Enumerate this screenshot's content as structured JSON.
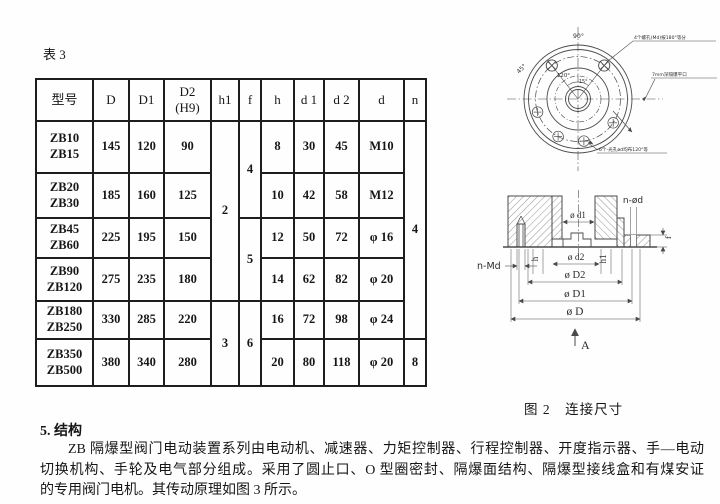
{
  "doc": {
    "table_caption": "表 3",
    "figure_caption": "图 2　连接尺寸",
    "section_heading": "5. 结构",
    "para_line1": "ZB 隔爆型阀门电动装置系列由电动机、减速器、力矩控制器、行程控制器、开度指示器、手—电动",
    "para_line2": "切换机构、手轮及电气部分组成。采用了圆止口、O 型圈密封、隔爆面结构、隔爆型接线盒和有煤安证",
    "para_line3": "的专用阀门电机。其传动原理如图 3 所示。"
  },
  "table": {
    "headers": {
      "model": "型号",
      "D": "D",
      "D1": "D1",
      "D2a": "D2",
      "D2b": "(H9)",
      "h1": "h1",
      "f": "f",
      "h": "h",
      "d1": "d 1",
      "d2": "d 2",
      "d": "d",
      "n": "n"
    },
    "rows": [
      {
        "models": [
          "ZB10",
          "ZB15"
        ],
        "D": "145",
        "D1": "120",
        "D2": "90",
        "h": "8",
        "d1": "30",
        "d2": "45",
        "d": "M10"
      },
      {
        "models": [
          "ZB20",
          "ZB30"
        ],
        "D": "185",
        "D1": "160",
        "D2": "125",
        "h": "10",
        "d1": "42",
        "d2": "58",
        "d": "M12"
      },
      {
        "models": [
          "ZB45",
          "ZB60"
        ],
        "D": "225",
        "D1": "195",
        "D2": "150",
        "h": "12",
        "d1": "50",
        "d2": "72",
        "d": "φ 16"
      },
      {
        "models": [
          "ZB90",
          "ZB120"
        ],
        "D": "275",
        "D1": "235",
        "D2": "180",
        "h": "14",
        "d1": "62",
        "d2": "82",
        "d": "φ 20"
      },
      {
        "models": [
          "ZB180",
          "ZB250"
        ],
        "D": "330",
        "D1": "285",
        "D2": "220",
        "h": "16",
        "d1": "72",
        "d2": "98",
        "d": "φ 24"
      },
      {
        "models": [
          "ZB350",
          "ZB500"
        ],
        "D": "380",
        "D1": "340",
        "D2": "280",
        "h": "20",
        "d1": "80",
        "d2": "118",
        "d": "φ 20"
      }
    ],
    "spans": {
      "h1_a": "2",
      "h1_b": "3",
      "f_a": "4",
      "f_b": "5",
      "f_c": "6",
      "n_a": "4",
      "n_b": "8"
    }
  },
  "figure": {
    "top": {
      "deg90": "90°",
      "deg45": "45°",
      "deg120": "120°",
      "deg15": "15°",
      "callout_top": "4个螺孔(Md)按180°等分",
      "callout_right": "7mm深隔爆平口",
      "callout_bottom": "6个-光孔ød均布120°等"
    },
    "section": {
      "d1": "ø d1",
      "nod": "n-ød",
      "nmd": "n-Md",
      "h": "h",
      "d2": "ø d2",
      "h1": "h1",
      "D2": "ø D2",
      "D1": "ø D1",
      "D": "ø D",
      "f": "f",
      "A": "A"
    }
  }
}
